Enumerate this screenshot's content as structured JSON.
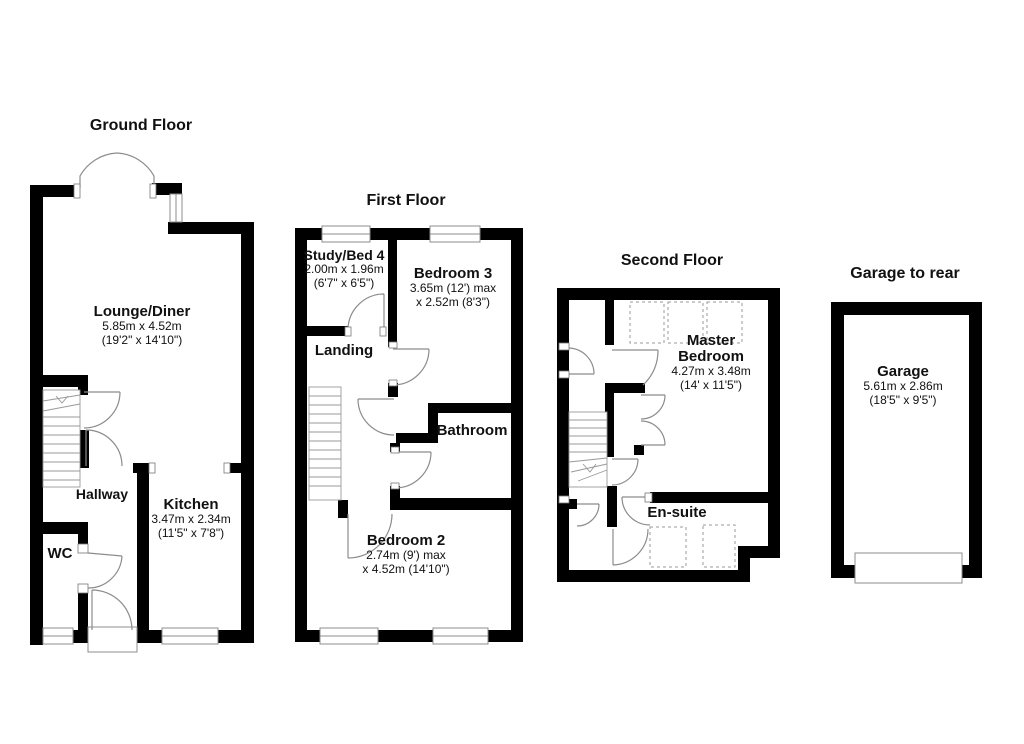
{
  "colors": {
    "wall": "#000000",
    "detail_line": "#8c8c8c",
    "text": "#111111",
    "background": "#ffffff"
  },
  "floors": {
    "ground": {
      "title": "Ground Floor",
      "rooms": {
        "lounge": {
          "name": "Lounge/Diner",
          "metric": "5.85m x 4.52m",
          "imperial": "(19'2\" x 14'10\")"
        },
        "hallway": {
          "name": "Hallway"
        },
        "kitchen": {
          "name": "Kitchen",
          "metric": "3.47m x 2.34m",
          "imperial": "(11'5\" x 7'8\")"
        },
        "wc": {
          "name": "WC"
        }
      }
    },
    "first": {
      "title": "First Floor",
      "rooms": {
        "study": {
          "name": "Study/Bed 4",
          "metric": "2.00m x 1.96m",
          "imperial": "(6'7\" x 6'5\")"
        },
        "bedroom3": {
          "name": "Bedroom 3",
          "metric": "3.65m (12') max",
          "imperial": "x 2.52m (8'3\")"
        },
        "landing": {
          "name": "Landing"
        },
        "bathroom": {
          "name": "Bathroom"
        },
        "bedroom2": {
          "name": "Bedroom 2",
          "metric": "2.74m (9') max",
          "imperial": "x 4.52m (14'10\")"
        }
      }
    },
    "second": {
      "title": "Second Floor",
      "rooms": {
        "master": {
          "name1": "Master",
          "name2": "Bedroom",
          "metric": "4.27m x 3.48m",
          "imperial": "(14' x 11'5\")"
        },
        "ensuite": {
          "name": "En-suite"
        }
      }
    },
    "garage": {
      "title": "Garage to rear",
      "rooms": {
        "garage": {
          "name": "Garage",
          "metric": "5.61m x 2.86m",
          "imperial": "(18'5\" x 9'5\")"
        }
      }
    }
  }
}
